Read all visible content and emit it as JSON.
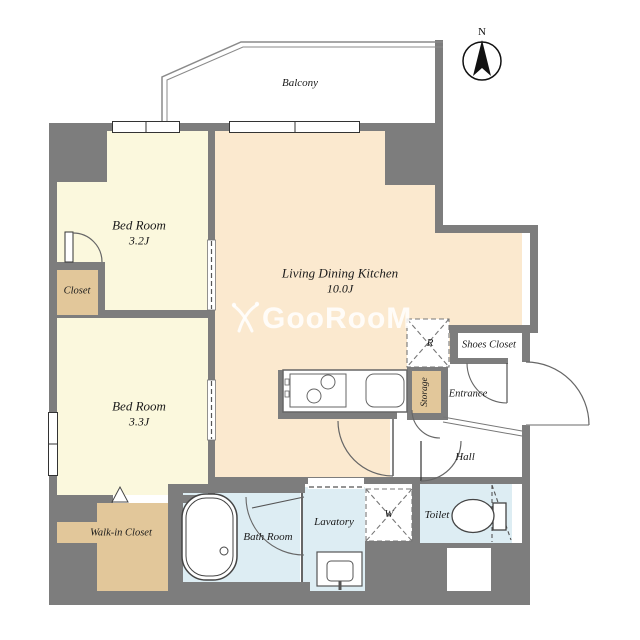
{
  "title": "Apartment floor plan",
  "colors": {
    "wall": "#7d7d7d",
    "bedroom": "#fbf8dd",
    "ldk": "#fbe9cf",
    "tan": "#e2c79a",
    "wet": "#ddedf3",
    "line": "#4a4a4a"
  },
  "compass": {
    "label": "N"
  },
  "balcony": {
    "label": "Balcony"
  },
  "rooms": {
    "bedroom1": {
      "label": "Bed Room",
      "size": "3.2J"
    },
    "bedroom2": {
      "label": "Bed Room",
      "size": "3.3J"
    },
    "ldk": {
      "label": "Living Dining Kitchen",
      "size": "10.0J"
    },
    "closet": {
      "label": "Closet"
    },
    "walkin": {
      "label": "Walk-in Closet"
    },
    "shoes": {
      "label": "Shoes Closet"
    },
    "entrance": {
      "label": "Entrance"
    },
    "hall": {
      "label": "Hall"
    },
    "storage": {
      "label": "Storage"
    },
    "bath": {
      "label": "Bath Room"
    },
    "lavatory": {
      "label": "Lavatory"
    },
    "toilet": {
      "label": "Toilet"
    }
  },
  "fixtures": {
    "refrigerator": "R",
    "washer": "W"
  },
  "watermark": {
    "text": "GooRooM"
  }
}
